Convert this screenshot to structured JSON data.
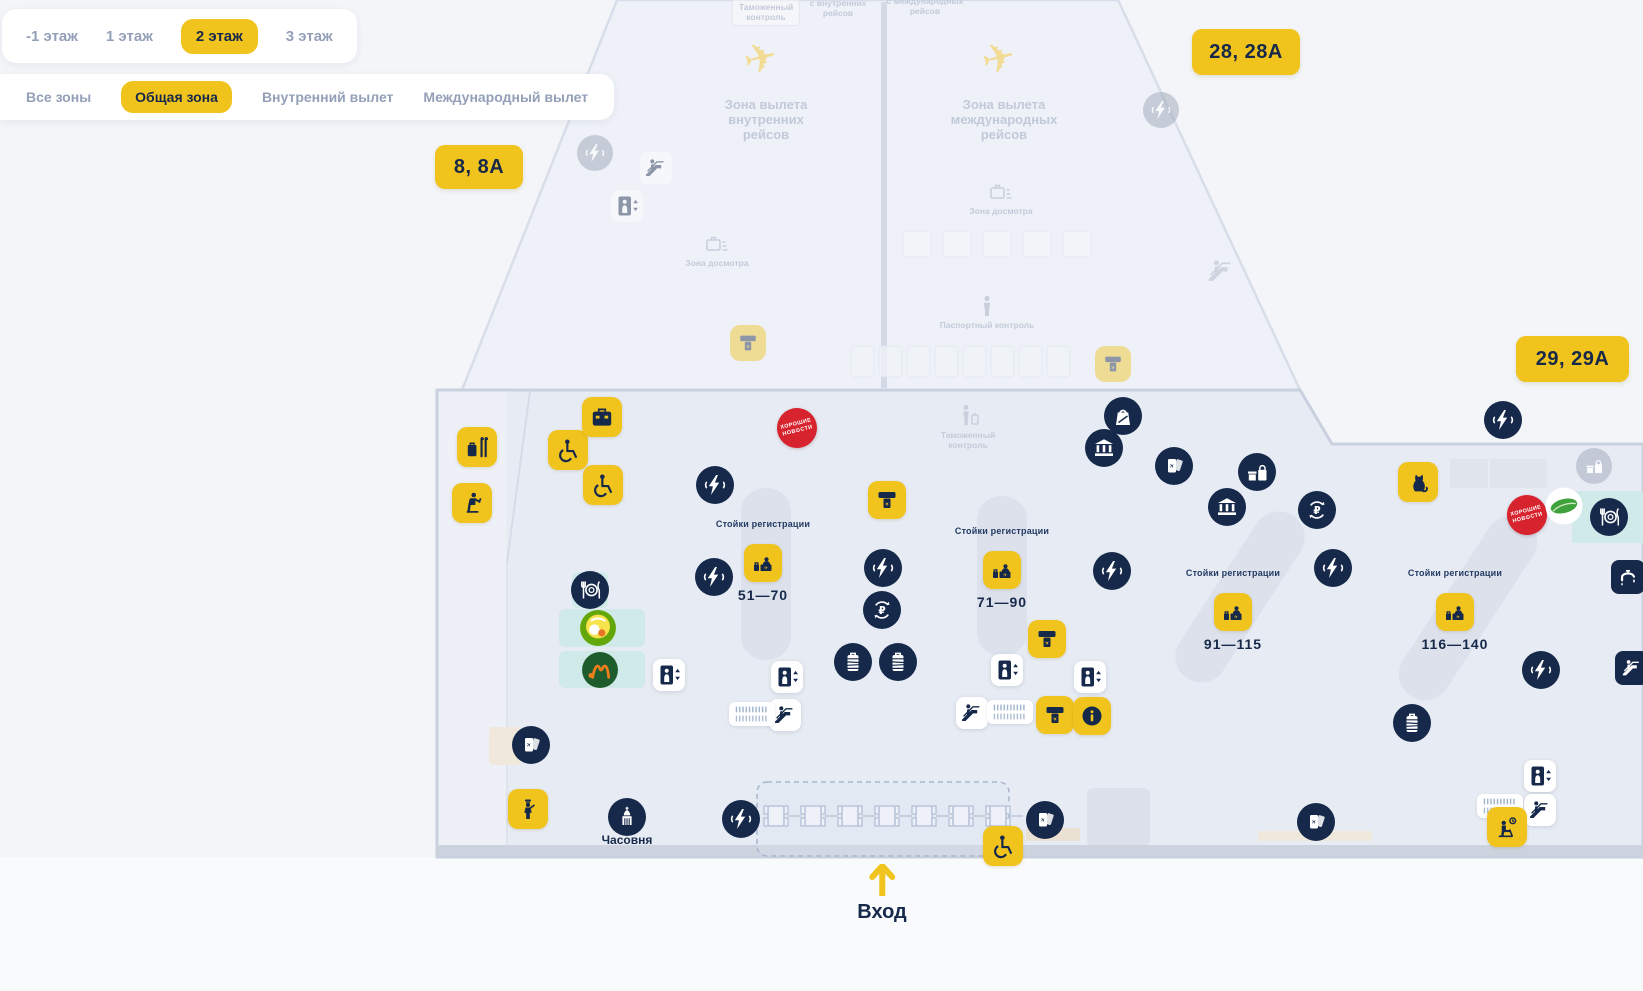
{
  "controls": {
    "floors": {
      "items": [
        {
          "label": "-1 этаж",
          "active": false
        },
        {
          "label": "1 этаж",
          "active": false
        },
        {
          "label": "2 этаж",
          "active": true
        },
        {
          "label": "3 этаж",
          "active": false
        }
      ]
    },
    "zones": {
      "items": [
        {
          "label": "Все зоны",
          "active": false
        },
        {
          "label": "Общая зона",
          "active": true
        },
        {
          "label": "Внутренний вылет",
          "active": false
        },
        {
          "label": "Международный вылет",
          "active": false
        }
      ]
    }
  },
  "colors": {
    "accent_yellow": "#f1c31d",
    "navy": "#16294a",
    "hall": "#e7ebf3",
    "red_badge": "#d6232e"
  },
  "map": {
    "entrance": {
      "label": "Вход"
    },
    "gate_labels": [
      {
        "text": "8, 8A",
        "x": 435,
        "y": 145,
        "w": 88,
        "h": 44
      },
      {
        "text": "28, 28A",
        "x": 1192,
        "y": 29,
        "w": 108,
        "h": 46
      },
      {
        "text": "29, 29A",
        "x": 1516,
        "y": 336,
        "w": 113,
        "h": 46
      }
    ],
    "zone_areas": [
      {
        "n": "zone-domestic-departures",
        "lines": [
          "Зона вылета",
          "внутренних",
          "рейсов"
        ],
        "x": 766,
        "y": 97
      },
      {
        "n": "zone-international-departures",
        "lines": [
          "Зона вылета",
          "международных",
          "рейсов"
        ],
        "x": 1004,
        "y": 97
      }
    ],
    "labels": [
      {
        "n": "label-customs-control-top",
        "lines": [
          "Таможенный",
          "контроль"
        ],
        "x": 766,
        "y": -2,
        "cls": "boxed"
      },
      {
        "n": "label-from-domestic-flights",
        "lines": [
          "с внутренних",
          "рейсов"
        ],
        "x": 838,
        "y": -2
      },
      {
        "n": "label-from-international-flights",
        "lines": [
          "с международных",
          "рейсов"
        ],
        "x": 925,
        "y": -4
      },
      {
        "n": "label-screening-zone-left",
        "lines": [
          "Зона досмотра"
        ],
        "x": 717,
        "y": 258,
        "icon": "scan"
      },
      {
        "n": "label-screening-zone-right",
        "lines": [
          "Зона досмотра"
        ],
        "x": 1001,
        "y": 206,
        "icon": "scan"
      },
      {
        "n": "label-passport-control",
        "lines": [
          "Паспортный контроль"
        ],
        "x": 987,
        "y": 320,
        "icon": "person"
      },
      {
        "n": "label-customs-control-center",
        "lines": [
          "Таможенный",
          "контроль"
        ],
        "x": 968,
        "y": 430,
        "icon": "porter"
      }
    ],
    "chapel_label": {
      "text": "Часовня",
      "x": 627,
      "y": 833
    },
    "checkins": [
      {
        "label": "Стойки регистрации",
        "range": "51—70",
        "x": 763,
        "y": 563
      },
      {
        "label": "Стойки регистрации",
        "range": "71—90",
        "x": 1002,
        "y": 570
      },
      {
        "label": "Стойки регистрации",
        "range": "91—115",
        "x": 1233,
        "y": 612
      },
      {
        "label": "Стойки регистрации",
        "range": "116—140",
        "x": 1455,
        "y": 612
      }
    ],
    "icons": [
      {
        "n": "charging-station",
        "g": "bolt",
        "v": "navy",
        "x": 715,
        "y": 485
      },
      {
        "n": "charging-station",
        "g": "bolt",
        "v": "navy",
        "x": 714,
        "y": 577
      },
      {
        "n": "charging-station",
        "g": "bolt",
        "v": "navy",
        "x": 883,
        "y": 568
      },
      {
        "n": "charging-station",
        "g": "bolt",
        "v": "navy",
        "x": 1112,
        "y": 571
      },
      {
        "n": "charging-station",
        "g": "bolt",
        "v": "navy",
        "x": 1333,
        "y": 568
      },
      {
        "n": "charging-station",
        "g": "bolt",
        "v": "navy",
        "x": 1503,
        "y": 420
      },
      {
        "n": "charging-station",
        "g": "bolt",
        "v": "navy",
        "x": 1541,
        "y": 670
      },
      {
        "n": "charging-station",
        "g": "bolt",
        "v": "navy",
        "x": 741,
        "y": 819
      },
      {
        "n": "charging-station-faded",
        "g": "bolt",
        "v": "gray",
        "x": 595,
        "y": 153
      },
      {
        "n": "charging-station-faded",
        "g": "bolt",
        "v": "gray",
        "x": 1161,
        "y": 110
      },
      {
        "n": "currency-exchange",
        "g": "exchange",
        "v": "navy",
        "x": 882,
        "y": 610
      },
      {
        "n": "currency-exchange",
        "g": "exchange",
        "v": "navy",
        "x": 1317,
        "y": 510
      },
      {
        "n": "baggage-wrapping",
        "g": "wrap",
        "v": "navy",
        "x": 853,
        "y": 662
      },
      {
        "n": "baggage-wrapping",
        "g": "wrap",
        "v": "navy",
        "x": 898,
        "y": 662
      },
      {
        "n": "baggage-wrapping",
        "g": "wrap",
        "v": "navy",
        "x": 1412,
        "y": 723
      },
      {
        "n": "elevator",
        "g": "elevator",
        "v": "white",
        "x": 669,
        "y": 675
      },
      {
        "n": "elevator",
        "g": "elevator",
        "v": "white",
        "x": 787,
        "y": 677
      },
      {
        "n": "elevator",
        "g": "elevator",
        "v": "white",
        "x": 1007,
        "y": 670
      },
      {
        "n": "elevator",
        "g": "elevator",
        "v": "white",
        "x": 1090,
        "y": 677
      },
      {
        "n": "elevator",
        "g": "elevator",
        "v": "white",
        "x": 1540,
        "y": 776
      },
      {
        "n": "elevator-faded",
        "g": "elevator",
        "v": "whitef",
        "x": 627,
        "y": 206
      },
      {
        "n": "escalator",
        "g": "escalator",
        "v": "white",
        "x": 785,
        "y": 715
      },
      {
        "n": "escalator",
        "g": "escalator",
        "v": "white",
        "x": 972,
        "y": 713
      },
      {
        "n": "escalator",
        "g": "escalator",
        "v": "white",
        "x": 1540,
        "y": 810
      },
      {
        "n": "escalator-faded",
        "g": "escalator",
        "v": "whitef",
        "x": 656,
        "y": 168
      },
      {
        "n": "escalator-faded",
        "g": "escalator",
        "v": "plainf",
        "x": 1221,
        "y": 271
      },
      {
        "n": "stairs",
        "g": "stairs",
        "v": "stairs",
        "x": 752,
        "y": 714
      },
      {
        "n": "stairs",
        "g": "stairs",
        "v": "stairs",
        "x": 1010,
        "y": 712
      },
      {
        "n": "stairs",
        "g": "stairs",
        "v": "stairs",
        "x": 1500,
        "y": 806
      },
      {
        "n": "boarding-pass-printer",
        "g": "printer",
        "v": "yellow",
        "x": 887,
        "y": 500
      },
      {
        "n": "boarding-pass-printer",
        "g": "printer",
        "v": "yellow",
        "x": 1047,
        "y": 639
      },
      {
        "n": "boarding-pass-printer",
        "g": "printer",
        "v": "yellow",
        "x": 1055,
        "y": 715
      },
      {
        "n": "boarding-pass-printer-faded",
        "g": "printer",
        "v": "yellowf",
        "x": 748,
        "y": 343
      },
      {
        "n": "boarding-pass-printer-faded",
        "g": "printer",
        "v": "yellowf",
        "x": 1113,
        "y": 364
      },
      {
        "n": "information",
        "g": "info",
        "v": "yellow",
        "x": 1092,
        "y": 716
      },
      {
        "n": "flight-tickets",
        "g": "ticket",
        "v": "navy",
        "x": 531,
        "y": 745
      },
      {
        "n": "flight-tickets",
        "g": "ticket",
        "v": "navy",
        "x": 1174,
        "y": 466
      },
      {
        "n": "flight-tickets",
        "g": "ticket",
        "v": "navy",
        "x": 1045,
        "y": 820
      },
      {
        "n": "flight-tickets",
        "g": "ticket",
        "v": "navy",
        "x": 1316,
        "y": 822
      },
      {
        "n": "bank",
        "g": "bank",
        "v": "navy",
        "x": 1104,
        "y": 448
      },
      {
        "n": "bank",
        "g": "bank",
        "v": "navy",
        "x": 1227,
        "y": 507
      },
      {
        "n": "shop",
        "g": "shopbag",
        "v": "navy",
        "x": 1123,
        "y": 416
      },
      {
        "n": "gift-shop",
        "g": "gift",
        "v": "navy",
        "x": 1257,
        "y": 472
      },
      {
        "n": "gift-shop-faded",
        "g": "gift",
        "v": "grayf",
        "x": 1594,
        "y": 466
      },
      {
        "n": "restaurant",
        "g": "rest",
        "v": "navy",
        "x": 590,
        "y": 590
      },
      {
        "n": "restaurant",
        "g": "rest",
        "v": "navy",
        "x": 1609,
        "y": 517
      },
      {
        "n": "wheelchair-assistance",
        "g": "wheel",
        "v": "yellowsq",
        "x": 568,
        "y": 450
      },
      {
        "n": "wheelchair-assistance",
        "g": "wheel",
        "v": "yellowsq",
        "x": 603,
        "y": 485
      },
      {
        "n": "wheelchair-assistance",
        "g": "wheel",
        "v": "yellowsq",
        "x": 1003,
        "y": 846
      },
      {
        "n": "oversized-baggage",
        "g": "ski",
        "v": "yellowsq",
        "x": 477,
        "y": 447
      },
      {
        "n": "shoe-shine",
        "g": "shoe",
        "v": "yellowsq",
        "x": 472,
        "y": 503
      },
      {
        "n": "luggage-storage",
        "g": "case",
        "v": "yellowsq",
        "x": 602,
        "y": 417
      },
      {
        "n": "police-post",
        "g": "police",
        "v": "yellowsq",
        "x": 528,
        "y": 809
      },
      {
        "n": "pet-relief-room",
        "g": "cat",
        "v": "yellowsq",
        "x": 1418,
        "y": 482
      },
      {
        "n": "waiting-lounge",
        "g": "lounge",
        "v": "yellowsq",
        "x": 1507,
        "y": 827
      },
      {
        "n": "drinking-water",
        "g": "faucet",
        "v": "navysq",
        "x": 1628,
        "y": 577
      },
      {
        "n": "moving-walkway",
        "g": "escalator",
        "v": "navysq",
        "x": 1632,
        "y": 668
      },
      {
        "n": "chapel",
        "g": "chapel",
        "v": "navy",
        "x": 627,
        "y": 817
      }
    ],
    "brands": [
      {
        "n": "press-shop-good-news",
        "lines": [
          "ХОРОШИЕ",
          "НОВ⊙СТИ"
        ],
        "x": 797,
        "y": 428
      },
      {
        "n": "press-shop-good-news",
        "lines": [
          "ХОРОШИЕ",
          "НОВ⊙СТИ"
        ],
        "x": 1527,
        "y": 515
      },
      {
        "n": "cafe-kroshka-kartoshka-logo",
        "g": "kroshka",
        "x": 598,
        "y": 628
      },
      {
        "n": "cafe-mu-mu-logo",
        "g": "mumu",
        "x": 600,
        "y": 670
      },
      {
        "n": "pharmacy-logo",
        "g": "pharm",
        "x": 1564,
        "y": 506
      }
    ]
  }
}
